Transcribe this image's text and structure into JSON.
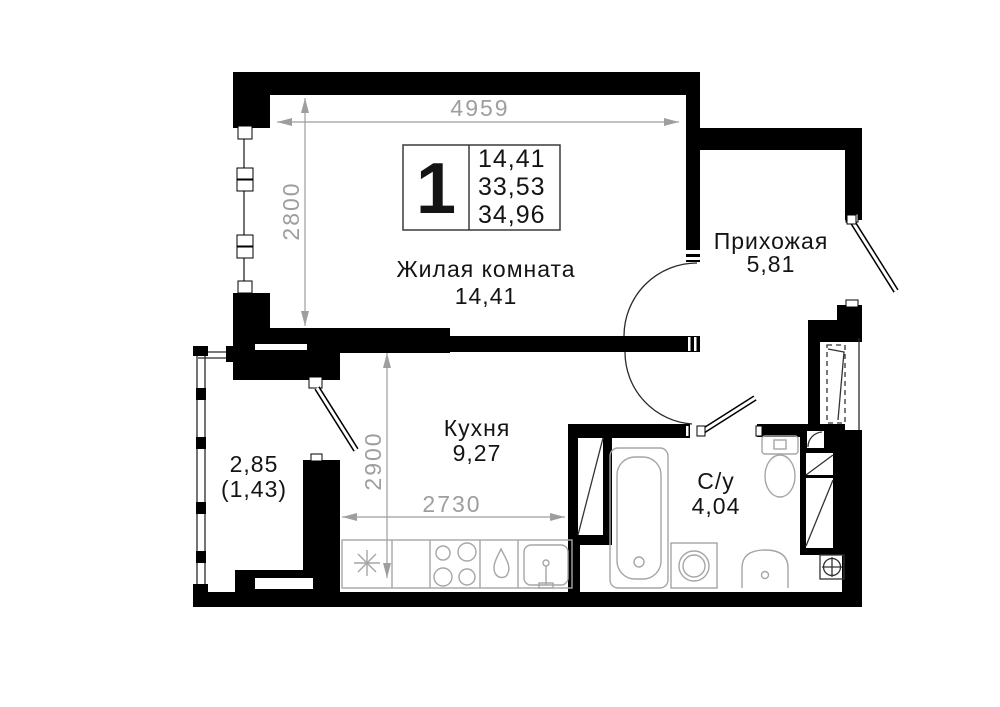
{
  "info_box": {
    "room_count": "1",
    "living_area": "14,41",
    "area_without_balcony": "33,53",
    "total_area": "34,96"
  },
  "rooms": {
    "living": {
      "name": "Жилая комната",
      "area": "14,41"
    },
    "hallway": {
      "name": "Прихожая",
      "area": "5,81"
    },
    "kitchen": {
      "name": "Кухня",
      "area": "9,27"
    },
    "bathroom": {
      "name": "С/у",
      "area": "4,04"
    },
    "balcony": {
      "area": "2,85",
      "area_coeff": "(1,43)"
    }
  },
  "dimensions": {
    "living_width_mm": "4959",
    "living_depth_mm": "2800",
    "kitchen_depth_mm": "2900",
    "kitchen_width_mm": "2730"
  },
  "colors": {
    "wall": "#000000",
    "dimension": "#9e9e9e",
    "fixture": "#a6a6a6",
    "label": "#141414",
    "background": "#ffffff"
  }
}
